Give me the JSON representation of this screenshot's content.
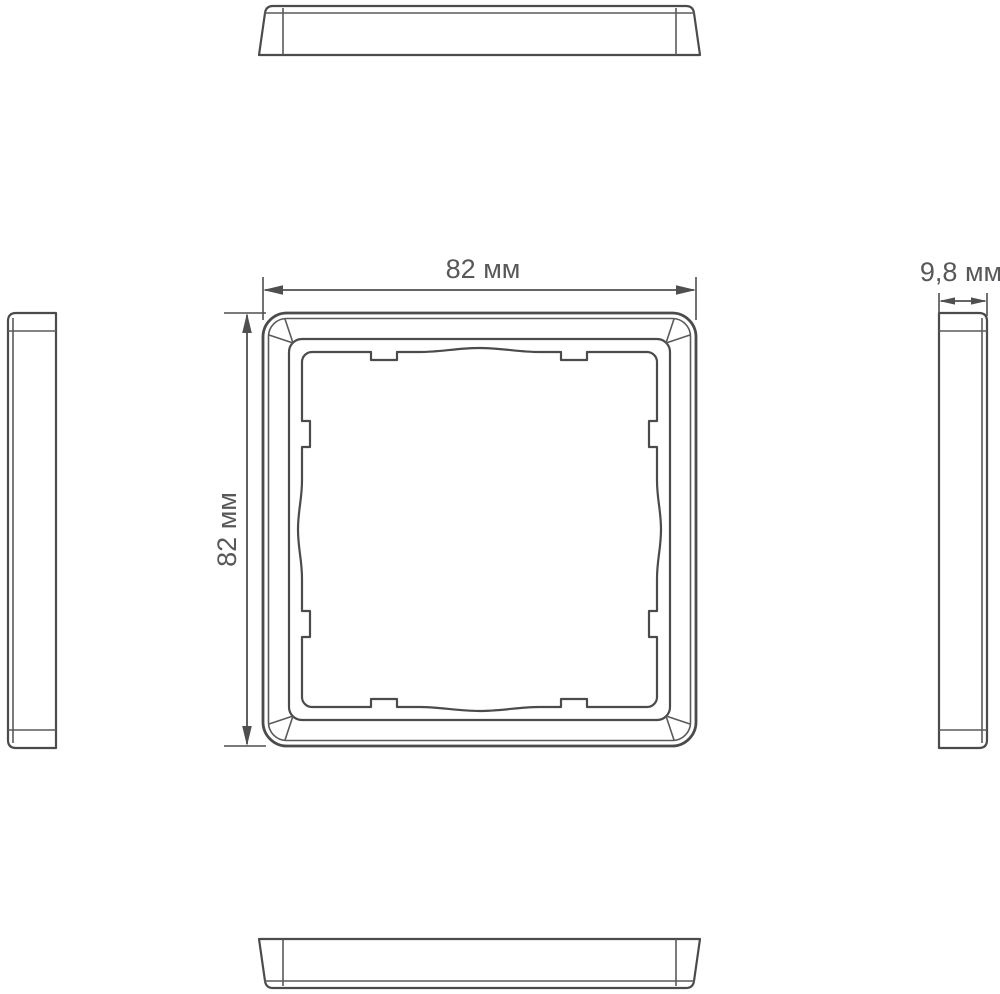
{
  "drawing": {
    "type": "technical-drawing",
    "subject": "square-frame-orthographic-views",
    "labels": {
      "width": "82 мм",
      "height": "82 мм",
      "depth": "9,8 мм"
    },
    "colors": {
      "line": "#4b4b4d",
      "dimension": "#4f4f51",
      "text": "#58585a",
      "background": "#ffffff"
    }
  }
}
